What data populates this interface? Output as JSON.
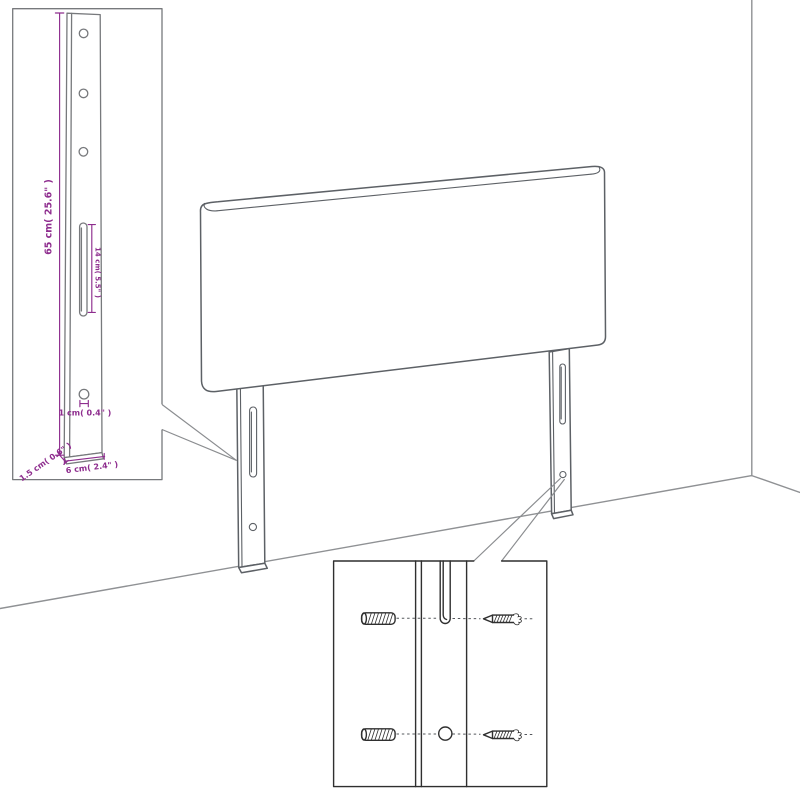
{
  "diagram": {
    "dimension_labels": {
      "leg_height": "65 cm( 25.6\" )",
      "slot_length": "14 cm( 5.5\" )",
      "hole_diameter": "1 cm( 0.4\" )",
      "leg_depth": "1.5 cm( 0.6\" )",
      "leg_width": "6 cm( 2.4\" )"
    },
    "colors": {
      "dimension": "#8e2d8e",
      "outline": "#5d6166",
      "detail": "#2f2f2f",
      "wall": "#8f9194"
    }
  }
}
